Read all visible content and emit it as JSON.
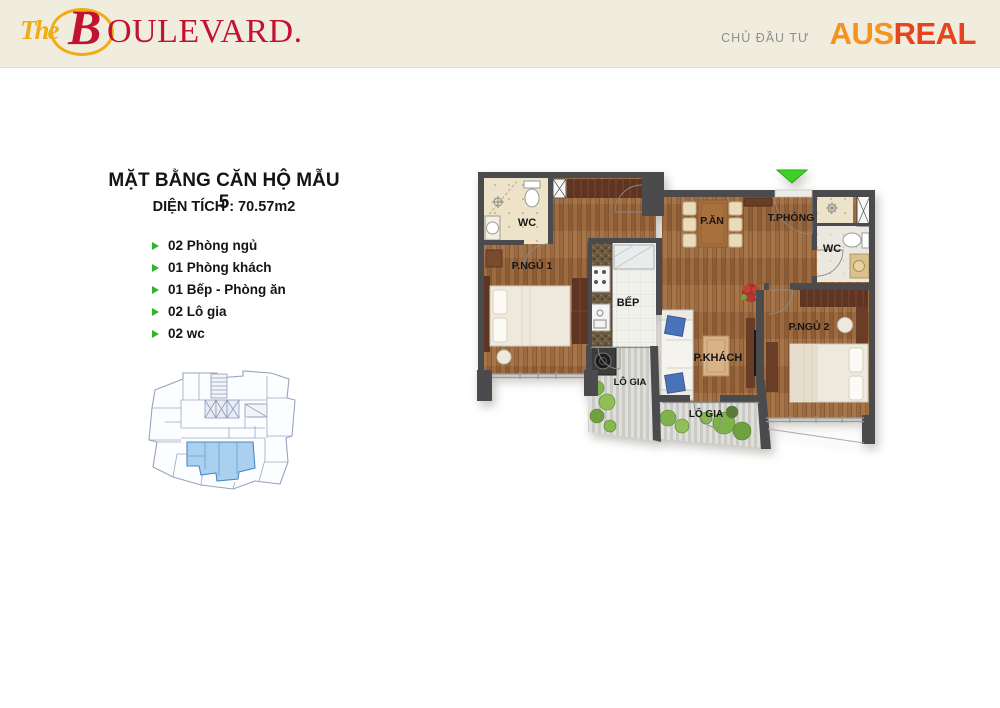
{
  "header": {
    "logo_the": "The",
    "logo_b": "B",
    "logo_rest": "OULEVARD.",
    "developer_label": "CHỦ ĐẦU TƯ",
    "developer_logo_part1": "AUS",
    "developer_logo_part2": "REAL"
  },
  "info": {
    "title": "MẶT BẰNG CĂN HỘ MẪU 5",
    "subtitle": "DIỆN TÍCH : 70.57m2",
    "features": [
      "02 Phòng ngủ",
      "01 Phòng khách",
      "01 Bếp - Phòng ăn",
      "02 Lô gia",
      "02 wc"
    ]
  },
  "floorplan": {
    "labels": {
      "wc1": "WC",
      "bedroom1": "P.NGỦ 1",
      "kitchen": "BẾP",
      "dining": "P.ĂN",
      "entry": "T.PHÒNG",
      "wc2": "WC",
      "living": "P.KHÁCH",
      "bedroom2": "P.NGỦ 2",
      "loggia_small": "LÔ GIA",
      "loggia_large": "LÔ GIA"
    }
  },
  "colors": {
    "header_bg": "#f0eddf",
    "logo_gold": "#efac15",
    "logo_red": "#c31230",
    "ausreal_orange": "#f6921e",
    "ausreal_red": "#e8431f",
    "bullet_green": "#2eb52a",
    "wall": "#4b4b4d",
    "wood_floor": "#9c6b41",
    "wc_tile": "#ece3c9",
    "keyplan_highlight": "#a9d0ee",
    "entry_arrow_green": "#3fd226"
  }
}
